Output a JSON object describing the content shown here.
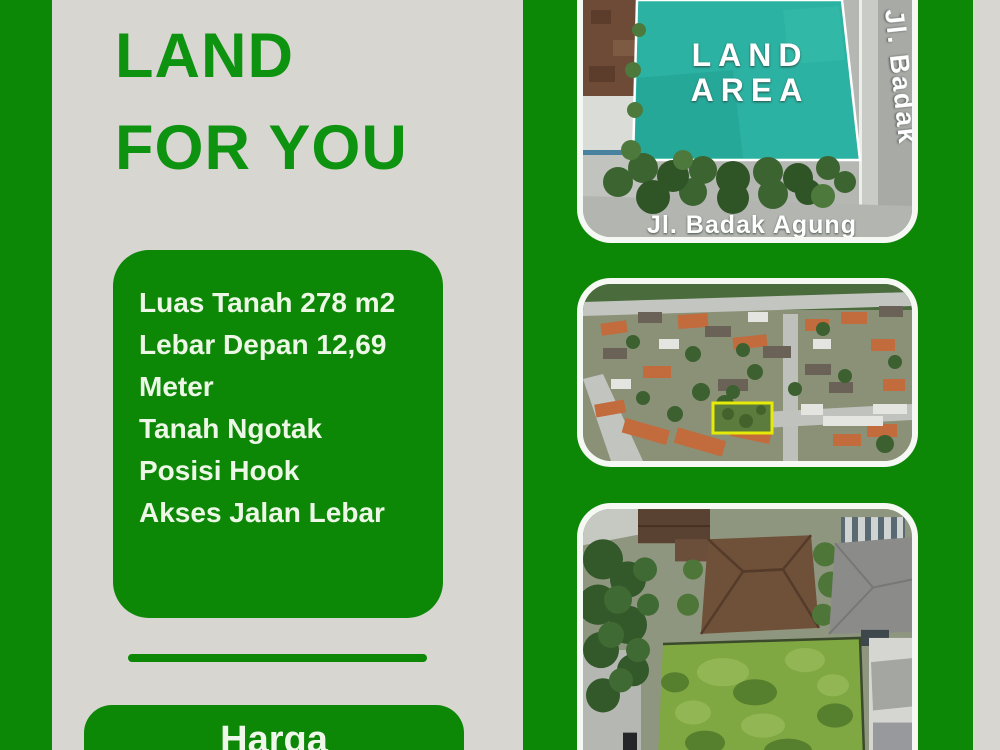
{
  "colors": {
    "page_background": "#d8d6d1",
    "brand_green": "#0c8706",
    "title_green": "#0e9311",
    "light_text": "#ecf7e6",
    "teal_overlay": "#2bb2a2",
    "plot_outline_yellow": "#e6ea08"
  },
  "left_column": {
    "title": {
      "line1": "LAND",
      "line2": "FOR YOU"
    },
    "details_card": {
      "lines": [
        "Luas Tanah 278 m2",
        "Lebar Depan 12,69 Meter",
        "Tanah Ngotak",
        "Posisi Hook",
        "Akses Jalan Lebar"
      ]
    },
    "price_section": {
      "label": "Harga"
    }
  },
  "photo_panel": {
    "top_photo": {
      "overlay_line1": "LAND",
      "overlay_line2": "AREA",
      "street_label_bottom": "Jl. Badak Agung",
      "street_label_right": "Jl. Badak"
    }
  }
}
